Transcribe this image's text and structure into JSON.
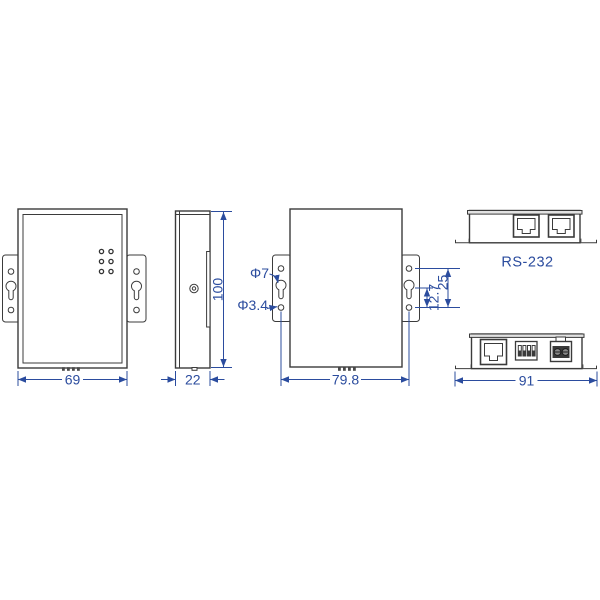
{
  "drawing": {
    "type": "mechanical-dimension-drawing",
    "background_color": "#ffffff",
    "outline_color": "#3b3b3b",
    "dimension_color": "#2b4c9e",
    "front_view": {
      "width_mm": "69"
    },
    "side_view": {
      "depth_mm": "22",
      "height_mm": "100"
    },
    "back_view": {
      "mount_hole_spacing_mm": "79.8",
      "keyhole_diameter": "Φ7",
      "screw_hole_diameter": "Φ3.4",
      "keyhole_to_hole_mm": "12.7",
      "hole_pitch_mm": "25"
    },
    "rear_panel_view": {
      "ports_label": "RS-232"
    },
    "bottom_panel_view": {
      "width_mm": "91"
    }
  }
}
